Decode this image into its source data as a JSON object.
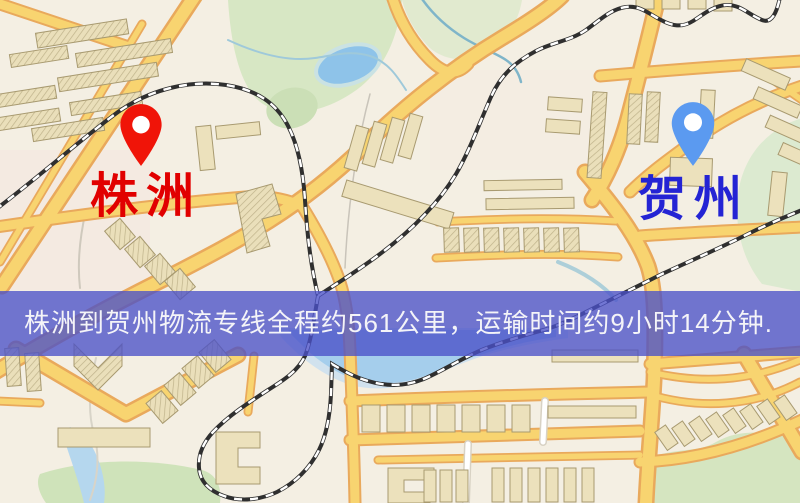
{
  "markers": {
    "origin": {
      "name": "株洲",
      "pin_color": "#f01408",
      "label_color": "#e10000"
    },
    "destination": {
      "name": "贺州",
      "pin_color": "#5b9af0",
      "label_color": "#2424d4"
    }
  },
  "banner": {
    "text": "株洲到贺州物流专线全程约561公里，运输时间约9小时14分钟.",
    "bg_color": "rgba(74,81,200,0.78)",
    "text_color": "#f4f4f8"
  },
  "route": {
    "origin": "株洲",
    "destination": "贺州",
    "distance_text": "约561公里",
    "duration_text": "约9小时14分钟"
  },
  "map_colors": {
    "background": "#f4efe3",
    "road_fill": "#f8d470",
    "road_casing": "#e9a95c",
    "park": "#d7e7c4",
    "water": "#a5ceec",
    "building": "#ece1bc",
    "railway": "#2f2f2f"
  }
}
